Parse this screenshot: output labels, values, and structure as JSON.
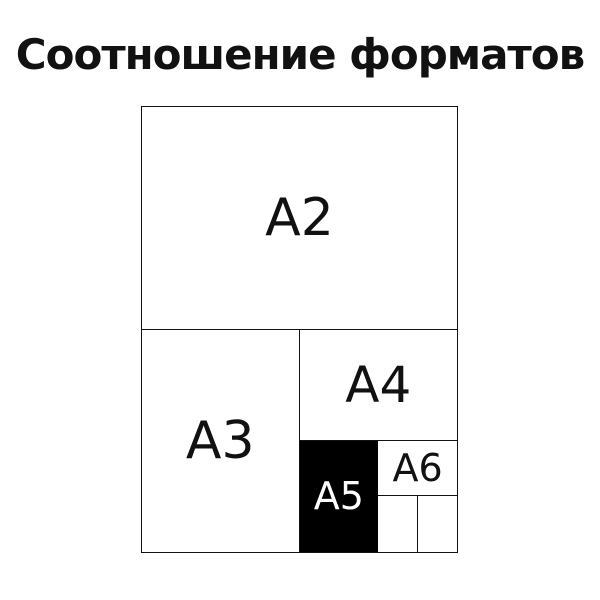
{
  "title": "Соотношение форматов",
  "colors": {
    "background": "#ffffff",
    "line": "#111111",
    "text": "#111111",
    "highlight_fill": "#000000",
    "highlight_text": "#ffffff"
  },
  "diagram": {
    "labels": {
      "a2": "A2",
      "a3": "A3",
      "a4": "A4",
      "a5": "A5",
      "a6": "A6"
    },
    "highlighted_format": "A5"
  }
}
